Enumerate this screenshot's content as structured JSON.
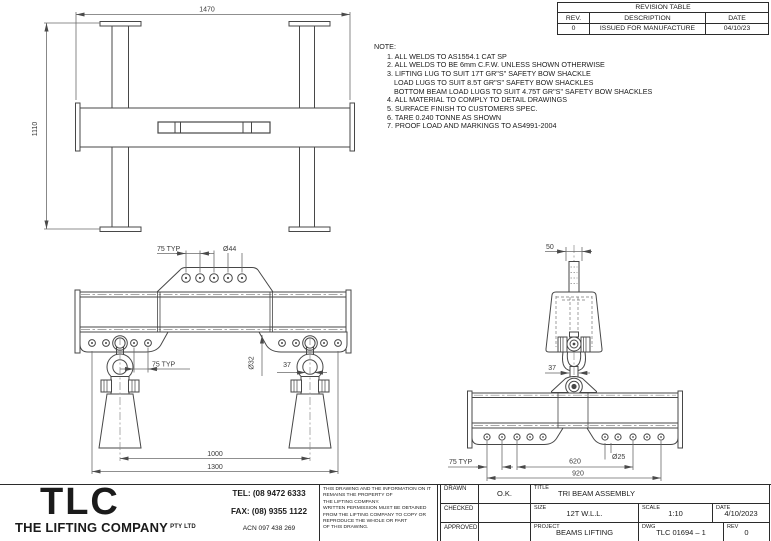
{
  "page": {
    "background": "#ffffff",
    "ink": "#3f3f3f",
    "text_color": "#1b1b1b"
  },
  "revision_table": {
    "title": "REVISION TABLE",
    "columns": [
      "REV.",
      "DESCRIPTION",
      "DATE"
    ],
    "rows": [
      {
        "rev": "0",
        "description": "ISSUED FOR MANUFACTURE",
        "date": "04/10/23"
      }
    ]
  },
  "notes": {
    "heading": "NOTE:",
    "items": [
      "1. ALL WELDS TO AS1554.1 CAT SP",
      "2. ALL WELDS TO BE 6mm C.F.W. UNLESS SHOWN OTHERWISE",
      "3. LIFTING LUG TO SUIT 17T GR\"S\" SAFETY BOW SHACKLE",
      "LOAD LUGS TO SUIT 8.5T GR\"S\" SAFETY BOW SHACKLES",
      "BOTTOM BEAM LOAD LUGS TO SUIT 4.75T GR\"S\" SAFETY BOW SHACKLES",
      "4. ALL MATERIAL TO COMPLY TO DETAIL DRAWINGS",
      "5. SURFACE FINISH TO CUSTOMERS SPEC.",
      "6. TARE 0.240 TONNE AS SHOWN",
      "7. PROOF LOAD AND MARKINGS TO AS4991-2004"
    ]
  },
  "views": {
    "plan": {
      "dim_width": "1470",
      "dim_height": "1110"
    },
    "front": {
      "pitch_top": "75 TYP",
      "dia_top": "Ø44",
      "pitch_bottom": "75 TYP",
      "plate_dia": "Ø32",
      "pin_width": "37",
      "span_inner": "1000",
      "span_outer": "1300"
    },
    "side": {
      "bar_width": "50",
      "link_width": "37",
      "pitch": "75 TYP",
      "span_mid": "620",
      "span_outer": "920",
      "hole_dia": "Ø25"
    }
  },
  "company": {
    "logo": "TLC",
    "name": "THE LIFTING COMPANY",
    "suffix": "PTY LTD",
    "tel": "TEL: (08 9472 6333",
    "fax": "FAX: (08) 9355 1122",
    "acn": "ACN 097 438 269",
    "disclaimer_lines": [
      "THIS DRAWING AND THE INFORMATION ON IT",
      "REMAINS THE PROPERTY OF",
      "THE LIFTING COMPANY.",
      "WRITTEN PERMISSION MUST BE OBTAINED",
      "FROM THE LIFTING COMPANY TO COPY OR",
      "REPRODUCE THE WHOLE OR PART",
      "OF THIS DRAWING."
    ]
  },
  "title_block": {
    "drawn_label": "DRAWN",
    "drawn_value": "O.K.",
    "checked_label": "CHECKED",
    "checked_value": "",
    "approved_label": "APPROVED",
    "approved_value": "",
    "title_label": "TITLE",
    "title_value": "TRI BEAM ASSEMBLY",
    "size_label": "SIZE",
    "size_value": "12T W.L.L.",
    "scale_label": "SCALE",
    "scale_value": "1:10",
    "date_label": "DATE",
    "date_value": "4/10/2023",
    "project_label": "PROJECT",
    "project_value": "BEAMS LIFTING",
    "dwg_label": "DWG",
    "dwg_value": "TLC 01694 – 1",
    "rev_label": "REV",
    "rev_value": "0"
  }
}
